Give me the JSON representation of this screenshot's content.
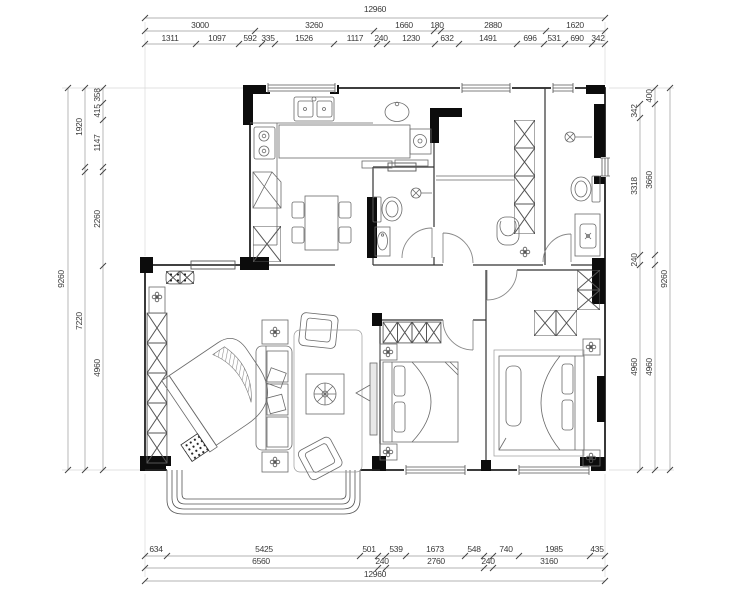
{
  "drawing_title": "apartment floor plan",
  "colors": {
    "background": "#ffffff",
    "walls": "#111111",
    "thin_lines": "#555555",
    "dimension_text": "#3a3a3a"
  },
  "dims": {
    "top": {
      "total": "12960",
      "row2": [
        "3000",
        "3260",
        "1660",
        "180",
        "2880",
        "1620"
      ],
      "row3": [
        "1311",
        "1097",
        "592",
        "335",
        "1526",
        "1117",
        "240",
        "1230",
        "632",
        "1491",
        "696",
        "531",
        "690",
        "342"
      ]
    },
    "bottom": {
      "row1": [
        "634",
        "5425",
        "501",
        "240",
        "539",
        "1673",
        "548",
        "240",
        "740",
        "1985",
        "435"
      ],
      "row2": [
        "6560",
        "2760",
        "3160"
      ],
      "total": "12960"
    },
    "left": {
      "outer": "9260",
      "middle": [
        "1920",
        "7220"
      ],
      "inner": [
        "358",
        "415",
        "1147",
        "2260",
        "4960"
      ]
    },
    "right": {
      "outer": "9260",
      "middle": [
        "400",
        "3660",
        "4960"
      ],
      "inner": [
        "342",
        "3318",
        "240",
        "4960"
      ]
    }
  }
}
